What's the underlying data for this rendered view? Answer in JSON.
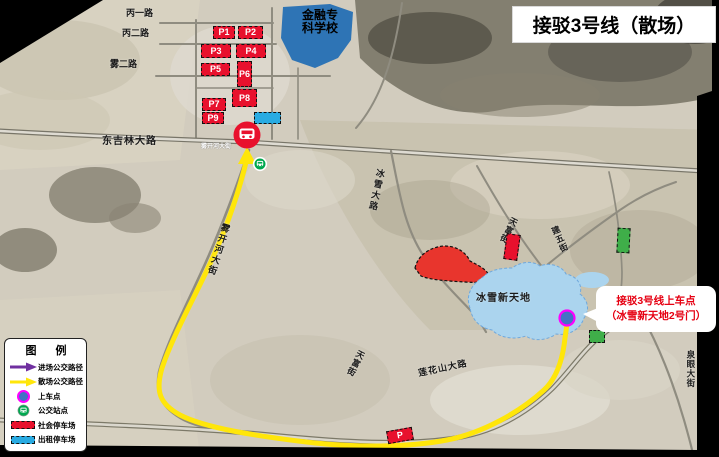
{
  "title": "接驳3号线（散场）",
  "callout": {
    "line1": "接驳3号线上车点",
    "line2": "（冰雪新天地2号门）"
  },
  "legend": {
    "title": "图  例",
    "items": [
      {
        "label": "进场公交路径",
        "icon": "purple-arrow",
        "color": "#7030a0"
      },
      {
        "label": "散场公交路径",
        "icon": "yellow-arrow",
        "color": "#ffe60a"
      },
      {
        "label": "上车点",
        "icon": "boarding-dot",
        "color": "#4472c4"
      },
      {
        "label": "公交站点",
        "icon": "bus-stop",
        "color": "#00a84f"
      },
      {
        "label": "社会停车场",
        "icon": "red-dashed-rect",
        "color": "#e8112d"
      },
      {
        "label": "出租停车场",
        "icon": "cyan-dashed-rect",
        "color": "#29abe2"
      }
    ]
  },
  "map": {
    "roads": {
      "bing1": "丙一路",
      "bing2": "丙二路",
      "wu2": "雾二路",
      "dongjilin": "东吉林大路",
      "wukaihe_small": "雾开河大街",
      "wukaihe": "雾开河大街",
      "bingxue": "冰雪大路",
      "tianfu_north": "天富街",
      "jianwu": "建五街",
      "tianfu_south": "天富街",
      "lianhuashan": "莲花山大路",
      "quanyan": "泉眼大街"
    },
    "areas": {
      "school_line1": "金融专",
      "school_line2": "科学校",
      "ice_world": "冰雪新天地"
    },
    "parking": [
      "P1",
      "P2",
      "P3",
      "P4",
      "P5",
      "P6",
      "P7",
      "P8",
      "P9"
    ],
    "parking_south": "P"
  },
  "colors": {
    "route_out": "#ffe60a",
    "route_in": "#7030a0",
    "parking_public": "#e8112d",
    "parking_taxi": "#29abe2",
    "boarding_fill": "#4472c4",
    "boarding_ring": "#ff00ff",
    "bus_stop": "#00a84f",
    "terminus": "#e8112d",
    "school_area": "#2e74b5",
    "ice_world_area": "#abd4ee"
  }
}
